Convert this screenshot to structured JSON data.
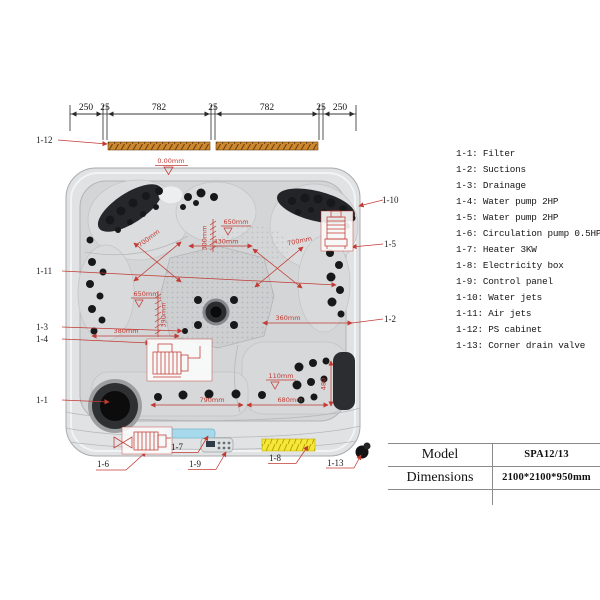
{
  "top_dimension": {
    "segments": [
      "250",
      "25",
      "782",
      "25",
      "782",
      "25",
      "250"
    ]
  },
  "dimensions": {
    "datum": "0.00mm",
    "seat_diag_left": "700mm",
    "seat_diag_center": "700mm",
    "center_depth": "650mm",
    "center_back": "300mm",
    "center_width": "430mm",
    "left_depth": "650mm",
    "left_back": "390mm",
    "left_width": "380mm",
    "lounger_top_width": "360mm",
    "lounger_datum": "110mm",
    "lounger_height": "480",
    "bench_width": "790mm",
    "lounger_width": "680mm"
  },
  "callouts": {
    "filter": "1-1",
    "suctions": "1-2",
    "drainage": "1-3",
    "water_pump_4": "1-4",
    "water_pump_5": "1-5",
    "circulation_pump": "1-6",
    "heater": "1-7",
    "electricity_box": "1-8",
    "control_panel": "1-9",
    "water_jets": "1-10",
    "air_jets": "1-11",
    "ps_cabinet": "1-12",
    "corner_drain_valve": "1-13"
  },
  "legend": {
    "items": [
      "1-1: Filter",
      "1-2: Suctions",
      "1-3: Drainage",
      "1-4: Water pump 2HP",
      "1-5: Water pump 2HP",
      "1-6: Circulation pump 0.5HP",
      "1-7: Heater 3KW",
      "1-8: Electricity box",
      "1-9: Control panel",
      "1-10: Water jets",
      "1-11: Air jets",
      "1-12: PS cabinet",
      "1-13: Corner drain valve"
    ]
  },
  "spec_table": {
    "rows": [
      {
        "label": "Model",
        "value": "SPA12/13"
      },
      {
        "label": "Dimensions",
        "value": "2100*2100*950mm"
      }
    ]
  },
  "colors": {
    "annotation_red": "#c23a32",
    "cabinet_orange": "#cd8830",
    "heater_blue": "#a6d9ec",
    "electricity_yellow": "#f5e73a"
  }
}
